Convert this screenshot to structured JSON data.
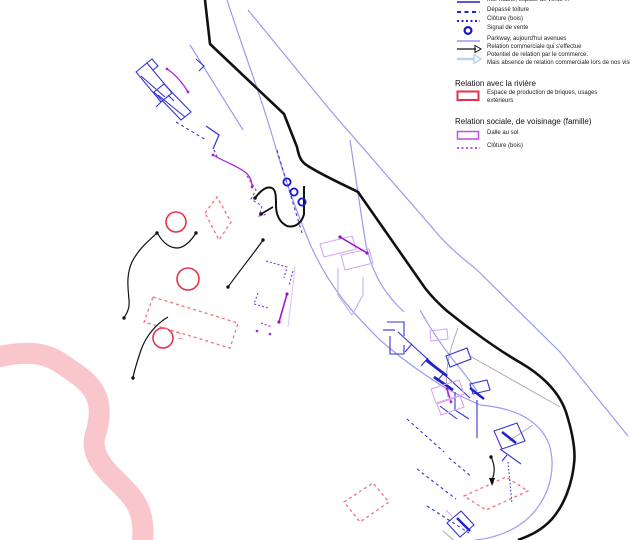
{
  "legend": {
    "items": [
      {
        "label": "Mur habité, espace de vente ...",
        "swatch": "solid-blue-line"
      },
      {
        "label": "Dépassé toiture",
        "swatch": "blue-dashes"
      },
      {
        "label": "Clôture (bois)",
        "swatch": "blue-dots"
      },
      {
        "label": "Signal de vente",
        "swatch": "blue-circle"
      },
      {
        "label": "Parkway, aujourd'hui avenues",
        "swatch": "periwinkle-line"
      },
      {
        "label": "Relation commerciale qui s'effectue",
        "swatch": "black-arrow"
      },
      {
        "label": "Potentiel de relation par le commerce.",
        "label2": "Mais absence de relation commerciale lors de nos visites",
        "swatch": "pale-blue-arrow"
      }
    ],
    "sections": [
      {
        "title": "Relation avec la rivière",
        "items": [
          {
            "label": "Espace de production de briques, usages",
            "label2": "extérieurs",
            "swatch": "red-rect"
          }
        ]
      },
      {
        "title": "Relation sociale, de voisinage (famille)",
        "items": [
          {
            "label": "Dalle au sol",
            "swatch": "violet-rect"
          },
          {
            "label": "Clôture (bois)",
            "swatch": "violet-dots"
          }
        ]
      }
    ]
  },
  "colors": {
    "legend_blue": "#2222cc",
    "signal_blue": "#1515cc",
    "building_blue": "#3434d6",
    "parkway_periwinkle": "#9a9af0",
    "pale_arrow_blue": "#bcd2ef",
    "road_black": "#111111",
    "river_relation_red": "#e8324a",
    "river_pink": "#f9c6cb",
    "social_violet": "#bb33ee",
    "slab_lavender": "#cfaaf5",
    "gray_line": "#aaaaaa"
  }
}
